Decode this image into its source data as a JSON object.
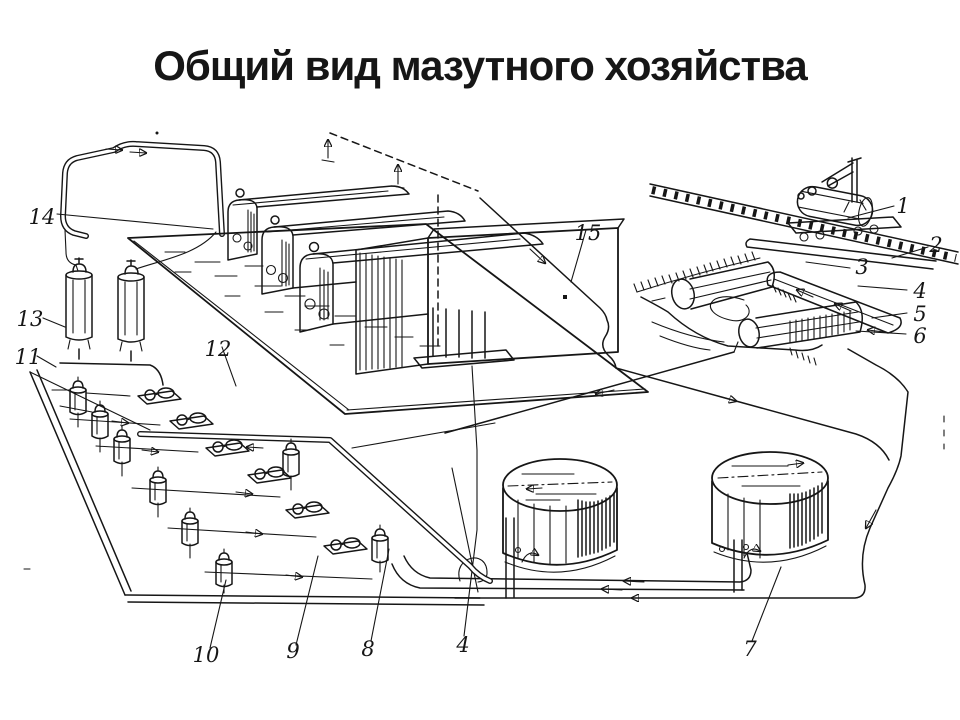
{
  "title": "Общий вид мазутного хозяйства",
  "colors": {
    "ink": "#161616",
    "background": "#ffffff"
  },
  "callouts": [
    {
      "label": "1"
    },
    {
      "label": "2"
    },
    {
      "label": "3"
    },
    {
      "label": "4"
    },
    {
      "label": "5"
    },
    {
      "label": "6"
    },
    {
      "label": "7"
    },
    {
      "label": "8"
    },
    {
      "label": "9"
    },
    {
      "label": "10"
    },
    {
      "label": "11"
    },
    {
      "label": "12"
    },
    {
      "label": "13"
    },
    {
      "label": "14"
    },
    {
      "label": "15"
    },
    {
      "label": "4"
    }
  ]
}
